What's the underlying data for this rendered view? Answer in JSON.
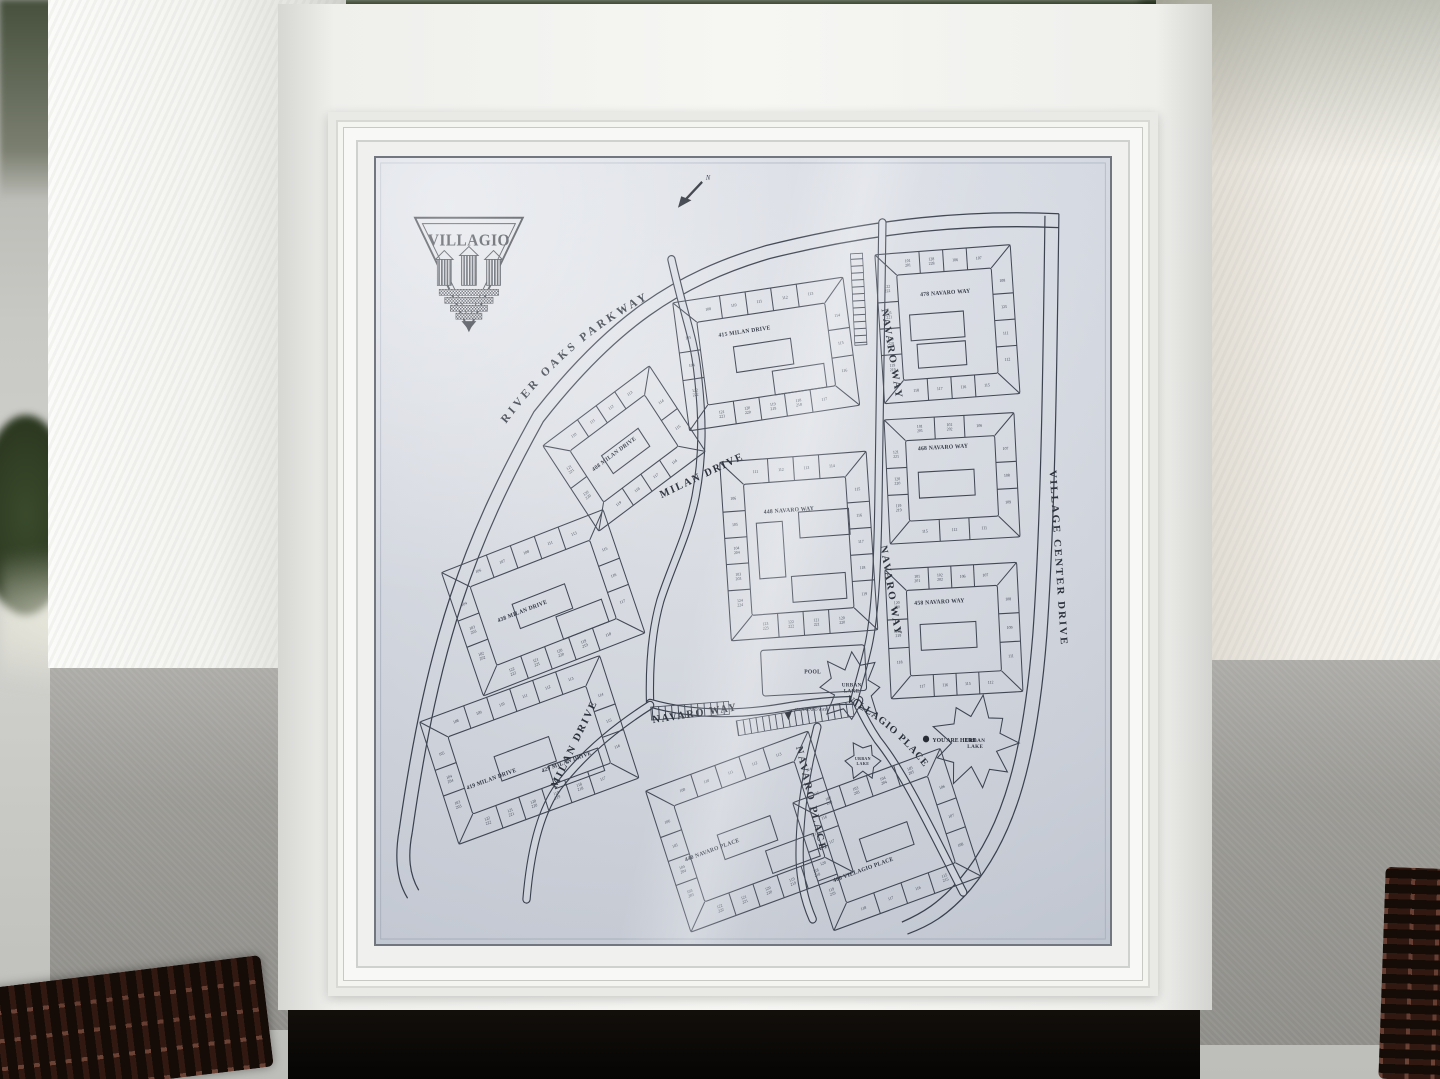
{
  "colors": {
    "panel_bg": "#e3e6ec",
    "map_ink": "#333945",
    "stucco_white": "#f2f1ee",
    "pedestal_gray": "#a09f9d",
    "tree_dark": "#2c3a26",
    "drain_brown": "#3c241d"
  },
  "sign": {
    "logo": {
      "text": "VILLAGIO"
    },
    "north_arrow": {
      "label": "N"
    },
    "streets": {
      "river_oaks": "RIVER OAKS PARKWAY",
      "milan_upper": "MILAN DRIVE",
      "milan_lower": "MILAN DRIVE",
      "navaro_way_ne": "NAVARO WAY",
      "navaro_way_e": "NAVARO WAY",
      "navaro_way_s": "NAVARO WAY",
      "village_center": "VILLAGE CENTER DRIVE",
      "villagio_place": "VILLAGIO PLACE",
      "navaro_place": "NAVARO PLACE"
    },
    "landmarks": {
      "pool": "POOL",
      "urban_lake_1": "URBAN LAKE",
      "urban_lake_2": "URBAN LAKE",
      "urban_lake_3": "URBAN LAKE",
      "you_are_here": "YOU ARE HERE",
      "pool_callout": "451 NAVARO WAY"
    },
    "clusters": [
      {
        "id": "c1",
        "address": "408 MILAN DRIVE",
        "units": [
          "110",
          "111",
          "112",
          "113",
          "114",
          "115",
          "116",
          "117",
          "118",
          "119",
          "120 220",
          "121 221"
        ]
      },
      {
        "id": "c2",
        "address": "415 MILAN DRIVE",
        "units": [
          "108",
          "110",
          "111",
          "112",
          "113",
          "114",
          "115",
          "116",
          "117",
          "118 218",
          "119 219",
          "120 220",
          "121 221",
          "122 222",
          "104",
          "105"
        ]
      },
      {
        "id": "c3",
        "address": "478 NAVARO WAY",
        "units": [
          "101 201",
          "128 228",
          "106",
          "107",
          "108",
          "125",
          "111",
          "112",
          "115",
          "116",
          "117",
          "118",
          "119 219",
          "120 220",
          "121 221",
          "122 222"
        ]
      },
      {
        "id": "c4",
        "address": "468 NAVARO WAY",
        "units": [
          "101 201",
          "102 202",
          "106",
          "107",
          "108",
          "109",
          "111",
          "112",
          "115",
          "119 219",
          "120 220",
          "121 221"
        ]
      },
      {
        "id": "c5",
        "address": "458 NAVARO WAY",
        "units": [
          "101 201",
          "102 202",
          "106",
          "107",
          "108",
          "109",
          "111",
          "112",
          "115",
          "116",
          "117",
          "118",
          "119 219",
          "120 220"
        ]
      },
      {
        "id": "c6",
        "address": "448 NAVARO WAY",
        "units": [
          "111",
          "112",
          "113",
          "114",
          "115",
          "116",
          "117",
          "118",
          "119",
          "120 220",
          "121 221",
          "122 222",
          "123 223",
          "124 224",
          "103 203",
          "104 204",
          "105",
          "106"
        ]
      },
      {
        "id": "c7",
        "address": "438 MILAN DRIVE",
        "units": [
          "106",
          "107",
          "108",
          "111",
          "113",
          "115",
          "116",
          "117",
          "118",
          "119 219",
          "120 220",
          "121 221",
          "122 222",
          "102 202",
          "103 203",
          "104"
        ]
      },
      {
        "id": "c8",
        "address": "419 MILAN DRIVE",
        "address2": "429 MILAN DRIVE",
        "units": [
          "108",
          "109",
          "110",
          "111",
          "112",
          "113",
          "114",
          "115",
          "116",
          "117",
          "118 218",
          "119 219",
          "120 220",
          "121 221",
          "122 222",
          "103 203",
          "104 204",
          "105"
        ]
      },
      {
        "id": "c9",
        "address": "440 NAVARO PLACE",
        "units": [
          "108",
          "110",
          "111",
          "112",
          "113",
          "114",
          "115",
          "116",
          "117",
          "118 218",
          "119 219",
          "120 220",
          "121 221",
          "122 222",
          "103 203",
          "104 204",
          "105",
          "106"
        ]
      },
      {
        "id": "c10",
        "address": "460 VILLAGIO PLACE",
        "units": [
          "102 202",
          "103 203",
          "104 204",
          "105 205",
          "106",
          "107",
          "108",
          "115 215",
          "116",
          "117",
          "118",
          "119 219",
          "120",
          "121"
        ]
      }
    ]
  }
}
